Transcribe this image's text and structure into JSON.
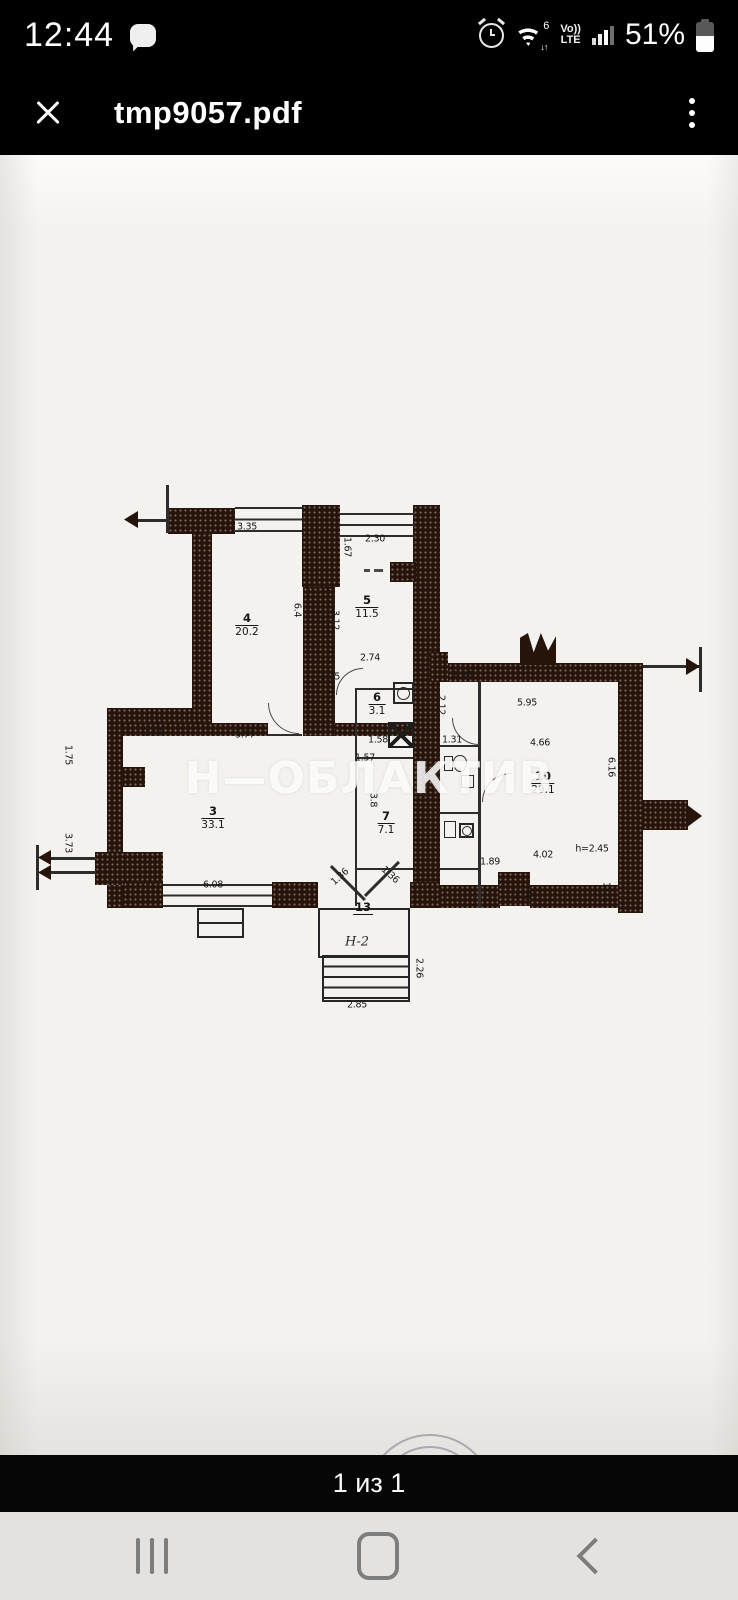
{
  "status_bar": {
    "time": "12:44",
    "battery": "51%",
    "wifi_number": "6",
    "wifi_arrows": "↓↑",
    "volte_top": "Vo))",
    "volte_bottom": "LTE"
  },
  "app_bar": {
    "title": "tmp9057.pdf"
  },
  "viewer": {
    "page_indicator": "1 из 1"
  },
  "floorplan": {
    "watermark": "Н—ОБЛАКТИВ",
    "entrance_label": "Н-2",
    "height_note": "h=2.45",
    "rooms": [
      {
        "number": "4",
        "area": "20.2",
        "x": 247,
        "y": 470
      },
      {
        "number": "5",
        "area": "11.5",
        "x": 367,
        "y": 452
      },
      {
        "number": "3",
        "area": "33.1",
        "x": 213,
        "y": 663
      },
      {
        "number": "6",
        "area": "3.1",
        "x": 377,
        "y": 549
      },
      {
        "number": "7",
        "area": "7.1",
        "x": 386,
        "y": 668
      },
      {
        "number": "10",
        "area": "29.1",
        "x": 543,
        "y": 628
      },
      {
        "number": "13",
        "area": "",
        "x": 363,
        "y": 753
      }
    ],
    "dims": [
      {
        "t": "3.35",
        "x": 247,
        "y": 372,
        "r": 0
      },
      {
        "t": "1.67",
        "x": 347,
        "y": 392,
        "r": 90
      },
      {
        "t": "2.30",
        "x": 375,
        "y": 384,
        "r": 0
      },
      {
        "t": "6.4",
        "x": 297,
        "y": 455,
        "r": 90
      },
      {
        "t": "3.12",
        "x": 335,
        "y": 465,
        "r": 90
      },
      {
        "t": "2.74",
        "x": 370,
        "y": 503,
        "r": 0
      },
      {
        "t": "1.15",
        "x": 330,
        "y": 522,
        "r": 0
      },
      {
        "t": "2.24",
        "x": 152,
        "y": 578,
        "r": 0
      },
      {
        "t": "3.77",
        "x": 245,
        "y": 580,
        "r": 0
      },
      {
        "t": "1.75",
        "x": 68,
        "y": 600,
        "r": 90
      },
      {
        "t": "3.73",
        "x": 68,
        "y": 688,
        "r": 90
      },
      {
        "t": "6.08",
        "x": 213,
        "y": 730,
        "r": 0
      },
      {
        "t": "1.58",
        "x": 378,
        "y": 585,
        "r": 0
      },
      {
        "t": "1.57",
        "x": 365,
        "y": 603,
        "r": 0
      },
      {
        "t": "3.8",
        "x": 373,
        "y": 645,
        "r": 90
      },
      {
        "t": "1.58",
        "x": 462,
        "y": 520,
        "r": 0
      },
      {
        "t": "1",
        "x": 523,
        "y": 516,
        "r": 0
      },
      {
        "t": "5.95",
        "x": 527,
        "y": 548,
        "r": 0
      },
      {
        "t": "4.66",
        "x": 540,
        "y": 588,
        "r": 0
      },
      {
        "t": "6.16",
        "x": 611,
        "y": 612,
        "r": 90
      },
      {
        "t": "2.12",
        "x": 441,
        "y": 550,
        "r": 90
      },
      {
        "t": "1.31",
        "x": 452,
        "y": 585,
        "r": 0
      },
      {
        "t": "1.89",
        "x": 490,
        "y": 707,
        "r": 0
      },
      {
        "t": "4.02",
        "x": 543,
        "y": 700,
        "r": 0
      },
      {
        "t": "h=2.45",
        "x": 592,
        "y": 694,
        "r": 0
      },
      {
        "t": "5.30",
        "x": 525,
        "y": 742,
        "r": 0
      },
      {
        "t": "1.73",
        "x": 606,
        "y": 737,
        "r": 90
      },
      {
        "t": "1.36",
        "x": 340,
        "y": 722,
        "r": -42
      },
      {
        "t": "1.36",
        "x": 390,
        "y": 720,
        "r": 42
      },
      {
        "t": "2.26",
        "x": 419,
        "y": 813,
        "r": 90
      },
      {
        "t": "2.85",
        "x": 357,
        "y": 850,
        "r": 0
      }
    ]
  }
}
